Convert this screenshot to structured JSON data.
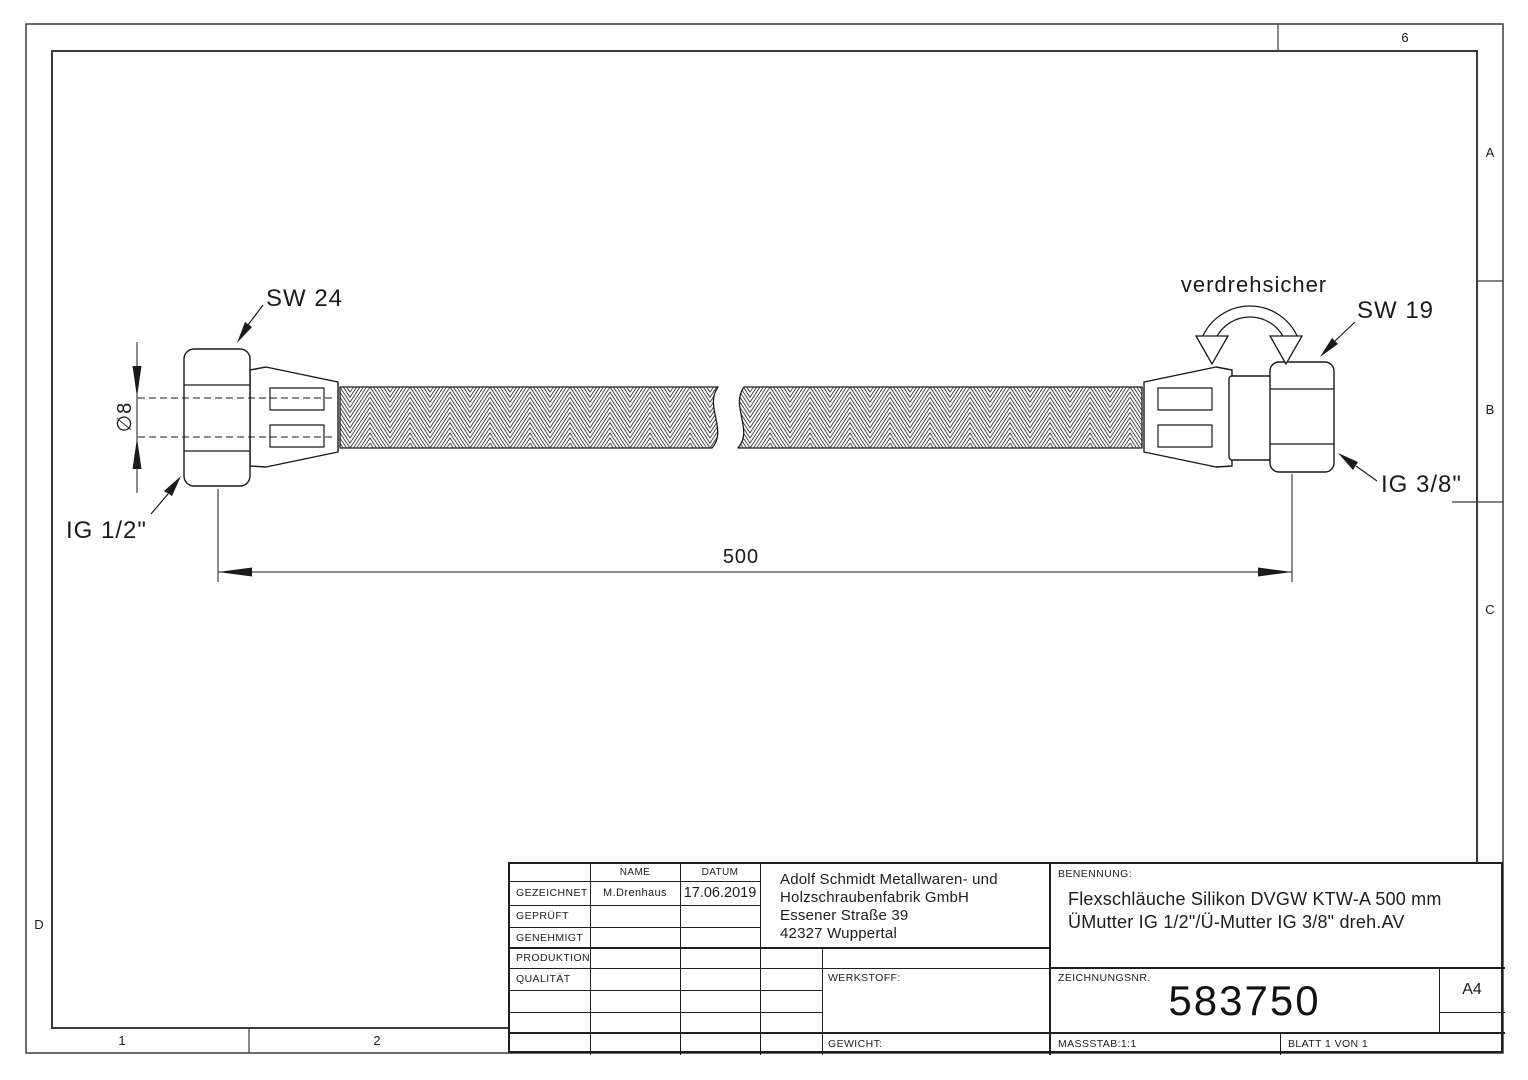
{
  "page": {
    "bg": "#ffffff",
    "line_color": "#1a1a1a"
  },
  "zones": {
    "top_col": "6",
    "row_a": "A",
    "row_b": "B",
    "row_c": "C",
    "row_d": "D",
    "col_1": "1",
    "col_2": "2"
  },
  "drawing": {
    "sw_left": "SW 24",
    "sw_right": "SW 19",
    "ig_left": "IG 1/2\"",
    "ig_right": "IG 3/8\"",
    "diameter": "∅8",
    "length": "500",
    "twist_note": "verdrehsicher"
  },
  "titleblock": {
    "name_header": "NAME",
    "date_header": "DATUM",
    "rows": [
      {
        "label": "GEZEICHNET",
        "name": "M.Drenhaus",
        "date": "17.06.2019"
      },
      {
        "label": "GEPRÜFT",
        "name": "",
        "date": ""
      },
      {
        "label": "GENEHMIGT",
        "name": "",
        "date": ""
      },
      {
        "label": "PRODUKTION",
        "name": "",
        "date": ""
      },
      {
        "label": "QUALITÄT",
        "name": "",
        "date": ""
      }
    ],
    "company": [
      "Adolf Schmidt Metallwaren- und",
      "Holzschraubenfabrik GmbH",
      "Essener Straße 39",
      "42327 Wuppertal"
    ],
    "werkstoff_label": "WERKSTOFF:",
    "gewicht_label": "GEWICHT:",
    "benennung_label": "BENENNUNG:",
    "benennung_line1": "Flexschläuche Silikon DVGW KTW-A  500 mm",
    "benennung_line2": "ÜMutter IG 1/2\"/Ü-Mutter IG 3/8\" dreh.AV",
    "zeichnungsnr_label": "ZEICHNUNGSNR.",
    "zeichnungsnr": "583750",
    "format": "A4",
    "massstab": "MASSSTAB:1:1",
    "blatt": "BLATT 1 VON 1"
  }
}
